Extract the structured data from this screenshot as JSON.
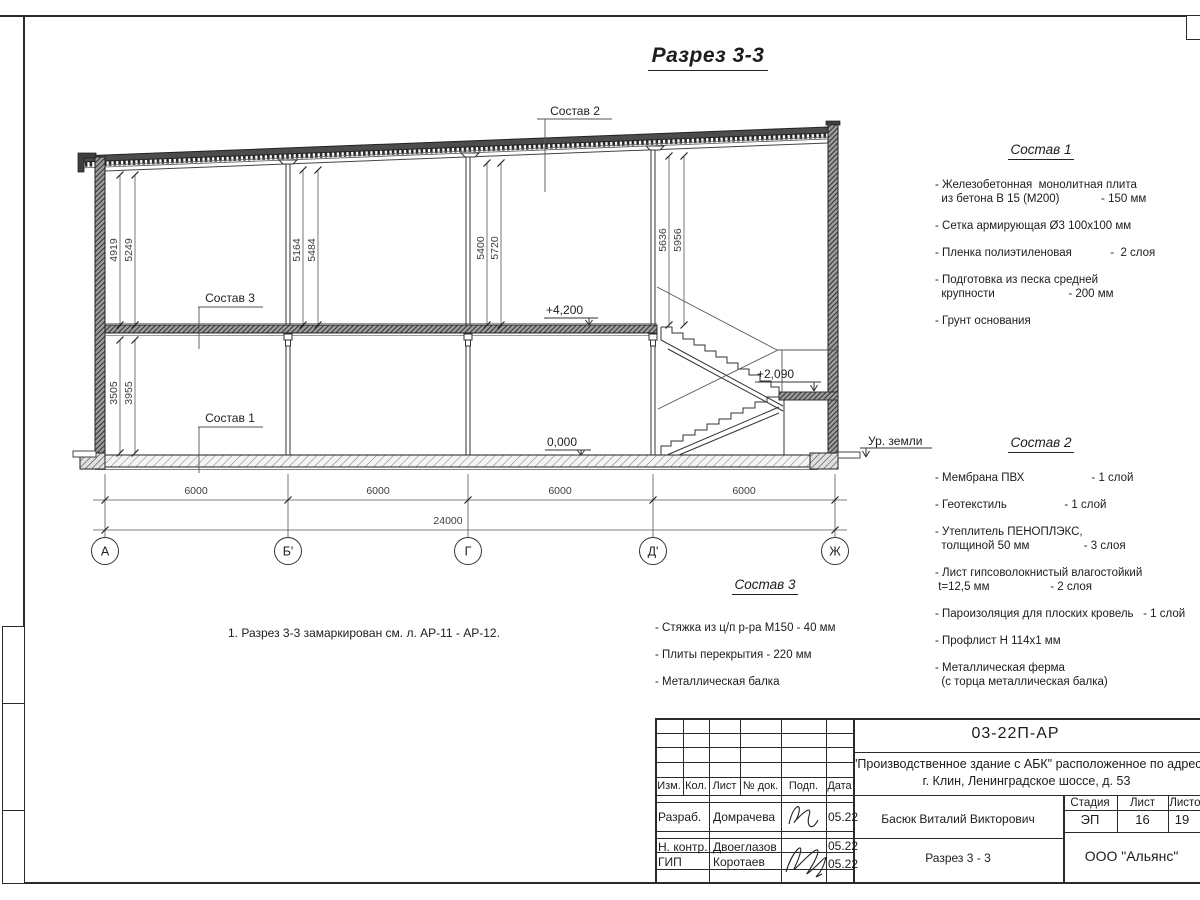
{
  "sheet": {
    "title": "Разрез 3-3"
  },
  "drawing": {
    "spec_labels": {
      "s1": "Состав 1",
      "s2": "Состав 2",
      "s3": "Состав 3"
    },
    "elevations": {
      "floor2": "+4,200",
      "zero": "0,000",
      "landing": "+2,090",
      "ground": "Ур. земли"
    },
    "vdims": {
      "a1": "4919",
      "a2": "5249",
      "b1": "5164",
      "b2": "5484",
      "g1": "5400",
      "g2": "5720",
      "d1": "5636",
      "d2": "5956",
      "low1": "3505",
      "low2": "3955"
    },
    "hdims": {
      "bay1": "6000",
      "bay2": "6000",
      "bay3": "6000",
      "bay4": "6000",
      "total": "24000"
    },
    "axes": {
      "a": "А",
      "b": "Б'",
      "g": "Г",
      "d": "Д'",
      "zh": "Ж"
    }
  },
  "spec1": {
    "title": "Состав 1",
    "items": [
      "- Железобетонная  монолитная плита\n  из бетона В 15 (М200)             - 150 мм",
      "- Сетка армирующая Ø3 100х100 мм",
      "- Пленка полиэтиленовая            -  2 слоя",
      "- Подготовка из песка средней\n  крупности                       - 200 мм",
      "- Грунт основания"
    ]
  },
  "spec2": {
    "title": "Состав 2",
    "items": [
      "- Мембрана ПВХ                     - 1 слой",
      "- Геотекстиль                  - 1 слой",
      "- Утеплитель ПЕНОПЛЭКС,\n  толщиной 50 мм                 - 3 слоя",
      "- Лист гипсоволокнистый влагостойкий\n t=12,5 мм                   - 2 слоя",
      "- Пароизоляция для плоских кровель   - 1 слой",
      "- Профлист Н 114х1 мм",
      "- Металлическая ферма\n  (с торца металлическая балка)"
    ]
  },
  "spec3": {
    "title": "Состав 3",
    "items": [
      "- Стяжка из ц/п р-ра М150 - 40 мм",
      "- Плиты перекрытия - 220 мм",
      "- Металлическая балка"
    ]
  },
  "note": "1. Разрез 3-3 замаркирован см. л. АР-11 - АР-12.",
  "titleblock": {
    "doc_number": "03-22П-АР",
    "project_line1": "\"Производственное здание с АБК\" расположенное по адресу",
    "project_line2": "г. Клин, Ленинградское шоссе, д. 53",
    "cols": {
      "izm": "Изм.",
      "kol": "Кол.",
      "list": "Лист",
      "ndok": "№ док.",
      "podp": "Подп.",
      "data": "Дата"
    },
    "rows": [
      {
        "role": "Разраб.",
        "name": "Домрачева",
        "date": "05.22"
      },
      {
        "role": "Н. контр.",
        "name": "Двоеглазов",
        "date": "05.22"
      },
      {
        "role": "ГИП",
        "name": "Коротаев",
        "date": "05.22"
      }
    ],
    "middle": {
      "author_full": "Басюк Виталий Викторович",
      "drawing_name": "Разрез 3 - 3"
    },
    "right": {
      "stage_label": "Стадия",
      "sheet_label": "Лист",
      "sheets_label": "Листов",
      "stage": "ЭП",
      "sheet": "16",
      "sheets": "19",
      "company": "ООО \"Альянс\""
    }
  }
}
